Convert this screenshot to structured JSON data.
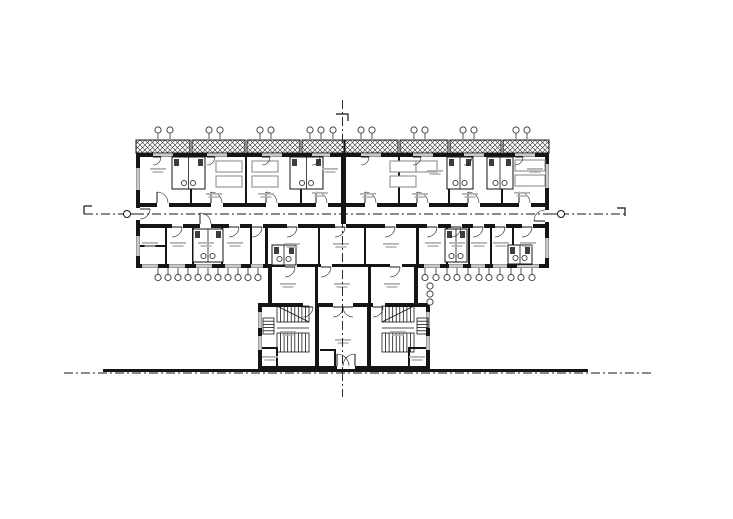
{
  "canvas": {
    "width": 733,
    "height": 519,
    "background": "#ffffff"
  },
  "palette": {
    "ink": "#151515",
    "furniture": "#8f8f8f",
    "fixture": "#3d3d3d",
    "label": "#b4b4b4",
    "vent": "#444444",
    "window_line": "#2a2a2a"
  },
  "drawing": {
    "balcony_band": {
      "y": 140,
      "h": 13,
      "segments": [
        [
          136,
          54
        ],
        [
          192,
          53
        ],
        [
          247,
          53
        ],
        [
          302,
          42
        ],
        [
          345,
          53
        ],
        [
          400,
          48
        ],
        [
          450,
          51
        ],
        [
          503,
          46
        ]
      ]
    },
    "walls": [
      [
        136,
        153,
        413,
        4
      ],
      [
        136,
        153,
        4,
        115
      ],
      [
        545,
        153,
        4,
        115
      ],
      [
        140,
        203,
        405,
        4
      ],
      [
        140,
        224,
        405,
        4
      ],
      [
        136,
        264,
        132,
        4
      ],
      [
        416,
        264,
        133,
        4
      ],
      [
        341,
        153,
        5,
        75
      ],
      [
        190,
        157,
        2,
        46
      ],
      [
        245,
        157,
        2,
        46
      ],
      [
        300,
        157,
        2,
        46
      ],
      [
        398,
        157,
        2,
        46
      ],
      [
        448,
        157,
        2,
        46
      ],
      [
        501,
        157,
        2,
        46
      ],
      [
        165,
        228,
        2,
        36
      ],
      [
        192,
        228,
        2,
        36
      ],
      [
        221,
        228,
        2,
        36
      ],
      [
        250,
        228,
        2,
        36
      ],
      [
        265,
        228,
        3,
        36
      ],
      [
        446,
        228,
        2,
        36
      ],
      [
        468,
        228,
        2,
        36
      ],
      [
        490,
        228,
        2,
        36
      ],
      [
        512,
        228,
        2,
        36
      ],
      [
        416,
        228,
        3,
        36
      ],
      [
        318,
        228,
        2,
        36
      ],
      [
        364,
        228,
        2,
        36
      ],
      [
        136,
        245,
        29,
        2
      ],
      [
        268,
        264,
        150,
        3
      ],
      [
        268,
        264,
        4,
        43
      ],
      [
        414,
        264,
        4,
        43
      ],
      [
        315,
        264,
        56,
        3
      ],
      [
        315,
        264,
        3,
        42
      ],
      [
        368,
        264,
        3,
        42
      ],
      [
        258,
        303,
        60,
        4
      ],
      [
        368,
        303,
        62,
        4
      ],
      [
        315,
        303,
        18,
        4
      ],
      [
        353,
        303,
        17,
        4
      ],
      [
        258,
        303,
        4,
        67
      ],
      [
        426,
        303,
        4,
        67
      ],
      [
        315,
        303,
        4,
        63
      ],
      [
        367,
        303,
        4,
        63
      ],
      [
        258,
        366,
        172,
        4
      ],
      [
        320,
        349,
        16,
        2
      ],
      [
        334,
        349,
        2,
        17
      ],
      [
        262,
        347,
        16,
        2
      ],
      [
        276,
        347,
        2,
        19
      ],
      [
        408,
        347,
        18,
        2
      ],
      [
        408,
        347,
        2,
        19
      ]
    ],
    "thin_walls": [
      [
        277,
        328,
        309,
        328
      ],
      [
        382,
        328,
        414,
        328
      ],
      [
        277,
        306,
        309,
        322
      ],
      [
        414,
        306,
        382,
        322
      ]
    ],
    "door_gaps": [
      [
        157,
        203,
        12,
        4
      ],
      [
        211,
        203,
        12,
        4
      ],
      [
        266,
        203,
        12,
        4
      ],
      [
        316,
        203,
        12,
        4
      ],
      [
        365,
        203,
        12,
        4
      ],
      [
        417,
        203,
        12,
        4
      ],
      [
        468,
        203,
        12,
        4
      ],
      [
        519,
        203,
        12,
        4
      ],
      [
        200,
        224,
        11,
        4
      ],
      [
        172,
        224,
        11,
        4
      ],
      [
        229,
        224,
        11,
        4
      ],
      [
        252,
        224,
        11,
        4
      ],
      [
        287,
        224,
        11,
        4
      ],
      [
        335,
        224,
        11,
        4
      ],
      [
        385,
        224,
        11,
        4
      ],
      [
        427,
        224,
        11,
        4
      ],
      [
        451,
        224,
        11,
        4
      ],
      [
        473,
        224,
        11,
        4
      ],
      [
        495,
        224,
        11,
        4
      ],
      [
        522,
        224,
        11,
        4
      ],
      [
        285,
        264,
        12,
        3
      ],
      [
        390,
        264,
        12,
        3
      ],
      [
        321,
        264,
        11,
        3
      ],
      [
        303,
        303,
        12,
        4
      ],
      [
        373,
        303,
        12,
        4
      ],
      [
        337,
        366,
        18,
        4
      ],
      [
        545,
        210,
        4,
        12
      ],
      [
        136,
        208,
        4,
        12
      ]
    ],
    "doors": [
      [
        157,
        203,
        11,
        0,
        0
      ],
      [
        211,
        203,
        11,
        0,
        0
      ],
      [
        266,
        203,
        11,
        0,
        0
      ],
      [
        316,
        203,
        11,
        0,
        0
      ],
      [
        365,
        203,
        11,
        0,
        0
      ],
      [
        417,
        203,
        11,
        0,
        0
      ],
      [
        468,
        203,
        11,
        0,
        0
      ],
      [
        519,
        203,
        11,
        0,
        0
      ],
      [
        200,
        224,
        11,
        0,
        0
      ],
      [
        172,
        227,
        10,
        90,
        0
      ],
      [
        229,
        227,
        10,
        90,
        0
      ],
      [
        252,
        227,
        10,
        90,
        0
      ],
      [
        287,
        227,
        10,
        90,
        0
      ],
      [
        335,
        227,
        10,
        90,
        0
      ],
      [
        385,
        227,
        10,
        90,
        0
      ],
      [
        427,
        227,
        10,
        90,
        0
      ],
      [
        451,
        227,
        10,
        90,
        0
      ],
      [
        473,
        227,
        10,
        90,
        0
      ],
      [
        495,
        227,
        10,
        90,
        0
      ],
      [
        522,
        227,
        10,
        90,
        0
      ],
      [
        153,
        157,
        8,
        90,
        0
      ],
      [
        207,
        157,
        8,
        90,
        0
      ],
      [
        262,
        157,
        8,
        90,
        0
      ],
      [
        312,
        157,
        8,
        90,
        0
      ],
      [
        361,
        157,
        8,
        90,
        0
      ],
      [
        413,
        157,
        8,
        90,
        0
      ],
      [
        464,
        157,
        8,
        90,
        0
      ],
      [
        515,
        157,
        8,
        90,
        0
      ],
      [
        285,
        267,
        10,
        90,
        0
      ],
      [
        390,
        267,
        10,
        90,
        0
      ],
      [
        321,
        267,
        10,
        90,
        0
      ],
      [
        303,
        307,
        10,
        90,
        0
      ],
      [
        373,
        307,
        10,
        90,
        0
      ],
      [
        333,
        307,
        10,
        90,
        0
      ],
      [
        353,
        307,
        10,
        270,
        1
      ],
      [
        337,
        366,
        12,
        0,
        0
      ],
      [
        355,
        366,
        12,
        0,
        1
      ],
      [
        545,
        221,
        11,
        270,
        0
      ],
      [
        140,
        209,
        10,
        90,
        0
      ]
    ],
    "windows": [
      [
        153,
        153,
        20,
        "h"
      ],
      [
        207,
        153,
        20,
        "h"
      ],
      [
        262,
        153,
        20,
        "h"
      ],
      [
        312,
        153,
        18,
        "h"
      ],
      [
        361,
        153,
        20,
        "h"
      ],
      [
        413,
        153,
        20,
        "h"
      ],
      [
        464,
        153,
        20,
        "h"
      ],
      [
        515,
        153,
        20,
        "h"
      ],
      [
        142,
        264,
        16,
        "h"
      ],
      [
        169,
        264,
        16,
        "h"
      ],
      [
        196,
        264,
        16,
        "h"
      ],
      [
        225,
        264,
        16,
        "h"
      ],
      [
        251,
        264,
        12,
        "h"
      ],
      [
        424,
        264,
        16,
        "h"
      ],
      [
        449,
        264,
        14,
        "h"
      ],
      [
        471,
        264,
        14,
        "h"
      ],
      [
        493,
        264,
        14,
        "h"
      ],
      [
        517,
        264,
        22,
        "h"
      ],
      [
        136,
        168,
        22,
        "v"
      ],
      [
        136,
        236,
        20,
        "v"
      ],
      [
        545,
        164,
        24,
        "v"
      ],
      [
        545,
        238,
        20,
        "v"
      ],
      [
        258,
        312,
        16,
        "v"
      ],
      [
        426,
        312,
        16,
        "v"
      ],
      [
        258,
        336,
        14,
        "v"
      ],
      [
        426,
        336,
        14,
        "v"
      ]
    ],
    "pods": [
      [
        172,
        157,
        33,
        32
      ],
      [
        290,
        157,
        33,
        32
      ],
      [
        447,
        157,
        26,
        32
      ],
      [
        487,
        157,
        26,
        32
      ],
      [
        193,
        229,
        30,
        33
      ],
      [
        445,
        229,
        22,
        33
      ],
      [
        508,
        245,
        24,
        19
      ],
      [
        272,
        245,
        24,
        20
      ]
    ],
    "beds": [
      [
        216,
        161,
        26,
        11
      ],
      [
        216,
        176,
        26,
        11
      ],
      [
        252,
        161,
        26,
        11
      ],
      [
        252,
        176,
        26,
        11
      ],
      [
        390,
        161,
        26,
        11
      ],
      [
        390,
        176,
        26,
        11
      ],
      [
        416,
        161,
        21,
        11
      ],
      [
        515,
        160,
        30,
        11
      ],
      [
        515,
        175,
        30,
        11
      ]
    ],
    "stairs": [
      [
        277,
        306,
        32,
        16,
        9,
        "v"
      ],
      [
        277,
        333,
        32,
        19,
        9,
        "v"
      ],
      [
        263,
        318,
        11,
        16,
        5,
        "h"
      ],
      [
        382,
        306,
        32,
        16,
        9,
        "v"
      ],
      [
        382,
        333,
        32,
        19,
        9,
        "v"
      ],
      [
        417,
        318,
        11,
        16,
        5,
        "h"
      ]
    ],
    "labels": [
      [
        158,
        168
      ],
      [
        330,
        168
      ],
      [
        435,
        170
      ],
      [
        535,
        168
      ],
      [
        214,
        193
      ],
      [
        266,
        193
      ],
      [
        320,
        192
      ],
      [
        368,
        193
      ],
      [
        420,
        193
      ],
      [
        470,
        193
      ],
      [
        522,
        192
      ],
      [
        150,
        242
      ],
      [
        178,
        242
      ],
      [
        206,
        242
      ],
      [
        235,
        242
      ],
      [
        292,
        243
      ],
      [
        341,
        243
      ],
      [
        391,
        243
      ],
      [
        433,
        242
      ],
      [
        457,
        242
      ],
      [
        479,
        242
      ],
      [
        501,
        242
      ],
      [
        528,
        242
      ],
      [
        288,
        283
      ],
      [
        342,
        283
      ],
      [
        392,
        283
      ],
      [
        288,
        331
      ],
      [
        398,
        331
      ],
      [
        343,
        339
      ],
      [
        270,
        356
      ],
      [
        417,
        356
      ]
    ],
    "vents": {
      "top_y": {
        "circle": 130,
        "stem_from": 139,
        "stem_to": 133
      },
      "top": [
        158,
        170,
        209,
        220,
        260,
        271,
        310,
        321,
        333,
        361,
        372,
        414,
        425,
        463,
        474,
        516,
        527
      ],
      "bottom_y": {
        "circle": 277.5,
        "stem_from": 268,
        "stem_to": 274
      },
      "bottom_left": [
        158,
        168,
        178,
        188,
        198,
        208,
        218,
        228,
        238,
        248,
        258
      ],
      "bottom_right": [
        425,
        436,
        447,
        457,
        468,
        479,
        489,
        500,
        511,
        521,
        532
      ],
      "stack": [
        [
          430,
          286
        ],
        [
          430,
          294
        ],
        [
          430,
          302
        ]
      ]
    },
    "centerlines": {
      "dash": "9 3 2 3",
      "horizontal": {
        "y": 214,
        "x1": 84,
        "x2": 625
      },
      "vertical": {
        "x": 342.5,
        "y1": 100,
        "y2": 397
      },
      "ground_dash": {
        "y": 373,
        "x1": 64,
        "x2": 652
      },
      "circles": [
        [
          127,
          214
        ],
        [
          561,
          214
        ]
      ],
      "stems": [
        [
          130,
          214,
          137,
          214
        ],
        [
          549,
          214,
          558,
          214
        ]
      ],
      "brackets": [
        [
          [
            84,
            206
          ],
          [
            84,
            214
          ]
        ],
        [
          [
            84,
            206
          ],
          [
            92,
            206
          ]
        ],
        [
          [
            617,
            208
          ],
          [
            625,
            208
          ],
          [
            625,
            216
          ]
        ],
        [
          [
            336,
            114
          ],
          [
            348,
            114
          ],
          [
            348,
            121
          ]
        ]
      ]
    },
    "ground_bar": [
      103,
      369,
      485,
      3
    ]
  }
}
